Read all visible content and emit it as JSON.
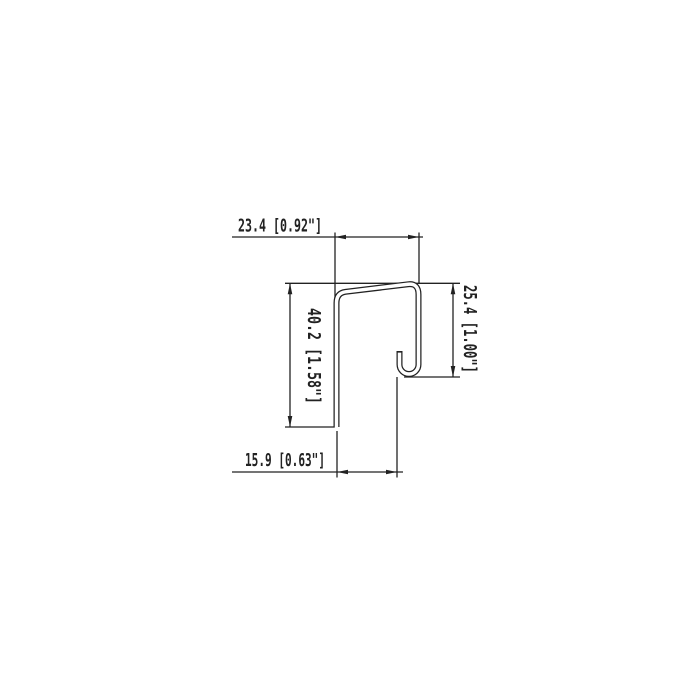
{
  "drawing": {
    "kind": "profile-cross-section-dimension-drawing",
    "units": "mm [inches]",
    "line_color": "#222222",
    "background_color": "#ffffff",
    "dimensions": {
      "top_width": {
        "label": "23.4 [0.92\"]",
        "mm": 23.4,
        "inches": 0.92
      },
      "right_height": {
        "label": "25.4 [1.00\"]",
        "mm": 25.4,
        "inches": 1.0
      },
      "left_height": {
        "label": "40.2 [1.58\"]",
        "mm": 40.2,
        "inches": 1.58
      },
      "bottom_width": {
        "label": "15.9 [0.63\"]",
        "mm": 15.9,
        "inches": 0.63
      }
    }
  }
}
